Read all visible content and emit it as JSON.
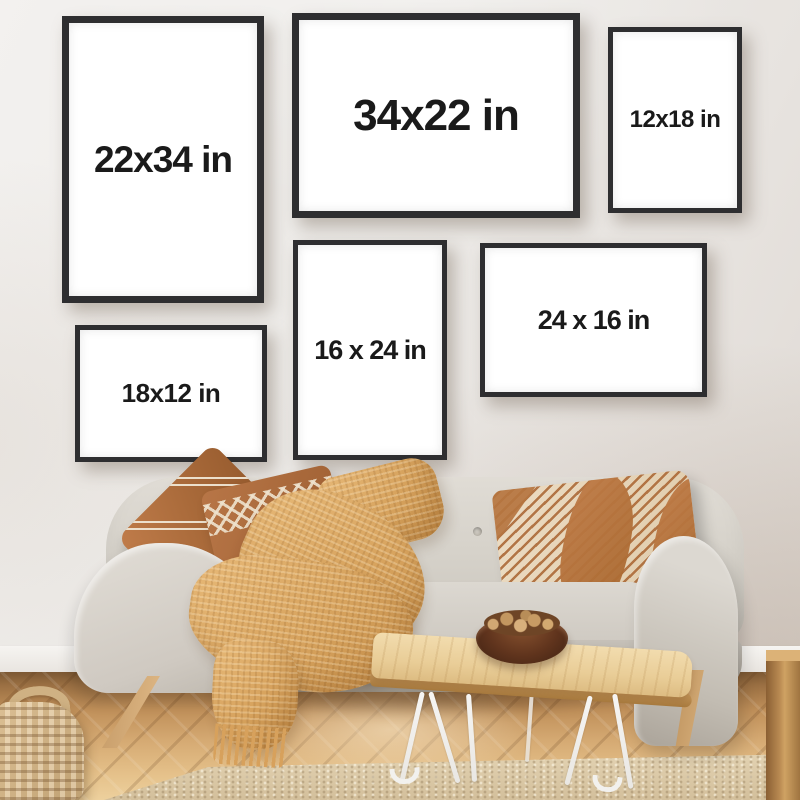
{
  "frames": [
    {
      "id": "frame-22x34",
      "label": "22x34 in",
      "orientation": "portrait"
    },
    {
      "id": "frame-34x22",
      "label": "34x22 in",
      "orientation": "landscape"
    },
    {
      "id": "frame-12x18",
      "label": "12x18 in",
      "orientation": "portrait"
    },
    {
      "id": "frame-16x24",
      "label": "16 x 24 in",
      "orientation": "portrait"
    },
    {
      "id": "frame-24x16",
      "label": "24 x 16 in",
      "orientation": "landscape"
    },
    {
      "id": "frame-18x12",
      "label": "18x12 in",
      "orientation": "landscape"
    }
  ],
  "colors": {
    "frame_border": "#2e2e30",
    "frame_matte": "#ffffff",
    "label_text": "#1a1a1a",
    "wall": "#edebe8",
    "sofa_fabric": "#d6d2ca",
    "pillow_caramel": "#ab6b3a",
    "pillow_cream": "#eee2cd",
    "blanket_mustard": "#d7a35e",
    "floor_wood": "#c0905a",
    "rug_beige": "#d8c5a2",
    "table_wood": "#e9cd97",
    "hairpin_leg": "#f4f3f1",
    "bowl_wood": "#5d341d"
  }
}
